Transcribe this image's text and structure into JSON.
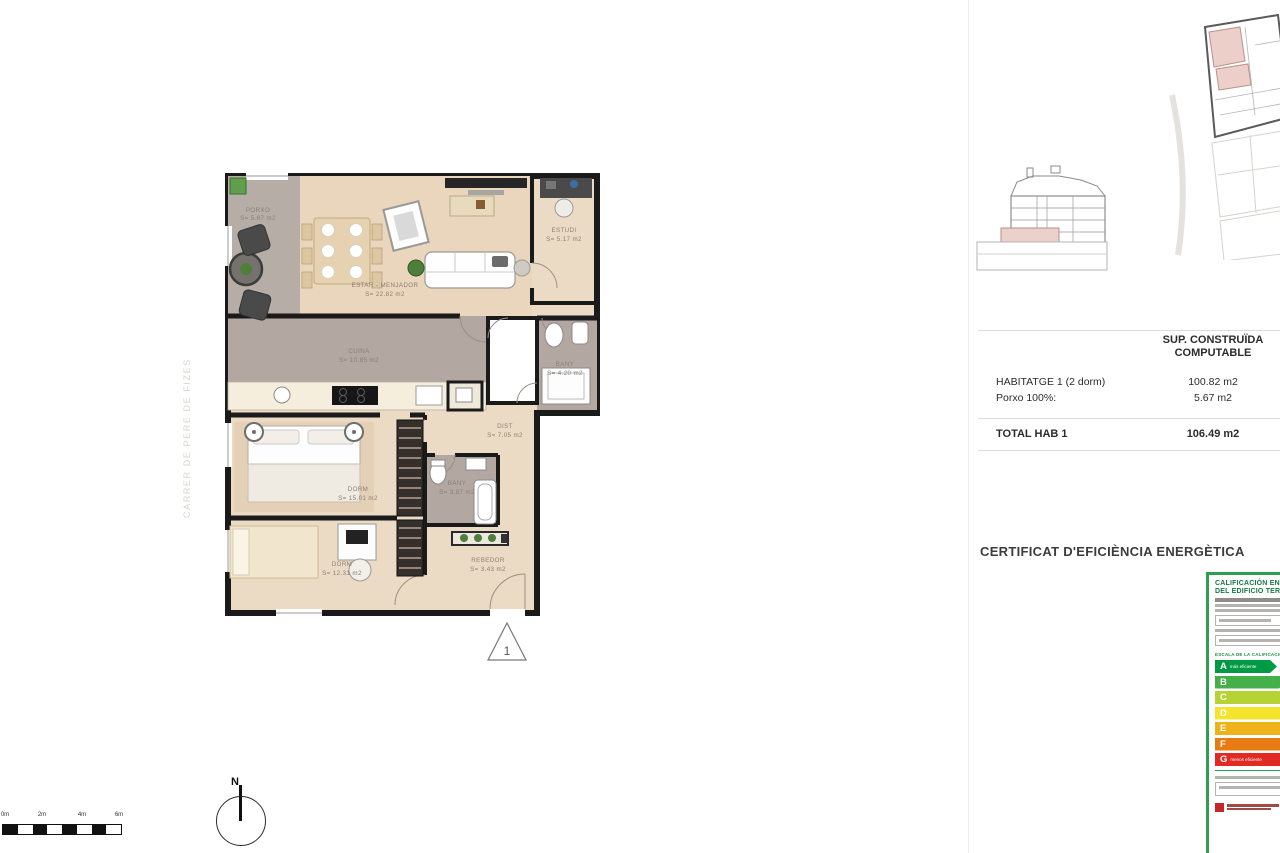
{
  "plan": {
    "street_label": "CARRER DE PERE DE FIZES",
    "north_label": "N",
    "unit_marker": "1",
    "scale_labels": [
      "0m",
      "2m",
      "4m",
      "6m"
    ],
    "rooms": [
      {
        "name": "PORXO",
        "area": "S= 5.67 m2"
      },
      {
        "name": "ESTAR - MENJADOR",
        "area": "S= 22.82 m2"
      },
      {
        "name": "ESTUDI",
        "area": "S= 5.17 m2"
      },
      {
        "name": "CUINA",
        "area": "S= 10.85 m2"
      },
      {
        "name": "BANY",
        "area": "S= 4.20 m2"
      },
      {
        "name": "DIST",
        "area": "S= 7.05 m2"
      },
      {
        "name": "DORM",
        "area": "S= 15.01 m2"
      },
      {
        "name": "BANY",
        "area": "S= 3.87 m2"
      },
      {
        "name": "DORM",
        "area": "S= 12.31 m2"
      },
      {
        "name": "REBEDOR",
        "area": "S= 3.43 m2"
      }
    ]
  },
  "summary_table": {
    "header_line1": "SUP. CONSTRUÏDA",
    "header_line2": "COMPUTABLE",
    "rows": [
      {
        "label": "HABITATGE 1 (2 dorm)",
        "value": "100.82 m2"
      },
      {
        "label": "Porxo 100%:",
        "value": "5.67 m2"
      }
    ],
    "total": {
      "label": "TOTAL HAB 1",
      "value": "106.49 m2"
    }
  },
  "certificate": {
    "heading": "CERTIFICAT D'EFICIÈNCIA ENERGÈTICA",
    "label_title_line1": "CALIFICACIÓN ENERGÉTICA",
    "label_title_line2": "DEL EDIFICIO TERMINADO",
    "scale_heading": "ESCALA DE LA CALIFICACIÓN ENERGÉTICA",
    "ratings": [
      {
        "letter": "A",
        "color": "#009a44",
        "note": "más eficiente"
      },
      {
        "letter": "B",
        "color": "#45b049"
      },
      {
        "letter": "C",
        "color": "#b5d334"
      },
      {
        "letter": "D",
        "color": "#f4e52c"
      },
      {
        "letter": "E",
        "color": "#eeb31b"
      },
      {
        "letter": "F",
        "color": "#e87b14"
      },
      {
        "letter": "G",
        "color": "#e02a23",
        "note": "menos eficiente"
      }
    ]
  }
}
